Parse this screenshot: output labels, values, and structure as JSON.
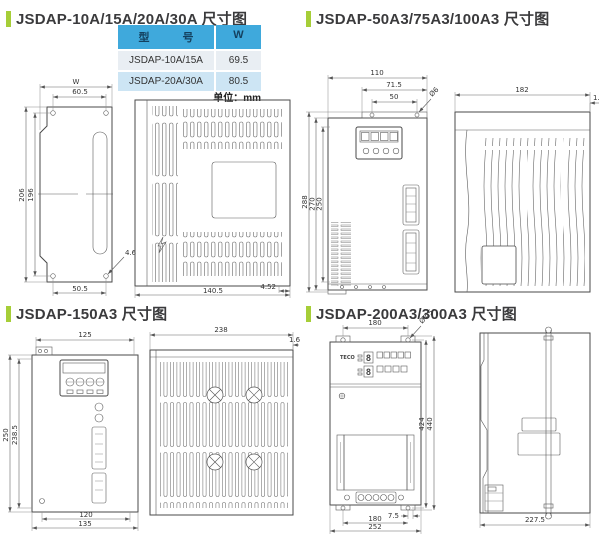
{
  "sections": {
    "tl": {
      "title": "JSDAP-10A/15A/20A/30A 尺寸图",
      "table": {
        "col_model": "型　　　号",
        "col_w": "W",
        "rows": [
          {
            "model": "JSDAP-10A/15A",
            "w": "69.5"
          },
          {
            "model": "JSDAP-20A/30A",
            "w": "80.5"
          }
        ],
        "unit_note": "单位：mm"
      },
      "dims": {
        "w_label": "W",
        "top_span": "60.5",
        "height_outer": "206",
        "height_inner": "196",
        "bottom_span": "50.5",
        "hole_note": "4.6",
        "depth": "140.5",
        "edge": "4.52"
      }
    },
    "tr": {
      "title": "JSDAP-50A3/75A3/100A3 尺寸图",
      "dims": {
        "width": "110",
        "span_mid": "71.5",
        "span_holes": "50",
        "hole_note": "Ø6",
        "height_outer": "288",
        "height_body": "270",
        "height_holes": "250",
        "depth": "182",
        "lip": "1.5"
      }
    },
    "bl": {
      "title": "JSDAP-150A3 尺寸图",
      "dims": {
        "width_top": "125",
        "height_outer": "250",
        "height_inner": "238.5",
        "bottom_inner": "120",
        "bottom_outer": "135",
        "depth": "238",
        "lip": "1.6"
      }
    },
    "br": {
      "title": "JSDAP-200A3/300A3 尺寸图",
      "brand": "TECO",
      "display_digit_top": "8",
      "display_digit_bottom": "8",
      "dims": {
        "top_span": "180",
        "hole_note": "Ø7.5",
        "height_inner": "424",
        "height_outer": "440",
        "bottom_offset": "7.5",
        "bottom_span": "180",
        "bottom_outer": "252",
        "depth": "227.5"
      }
    }
  }
}
